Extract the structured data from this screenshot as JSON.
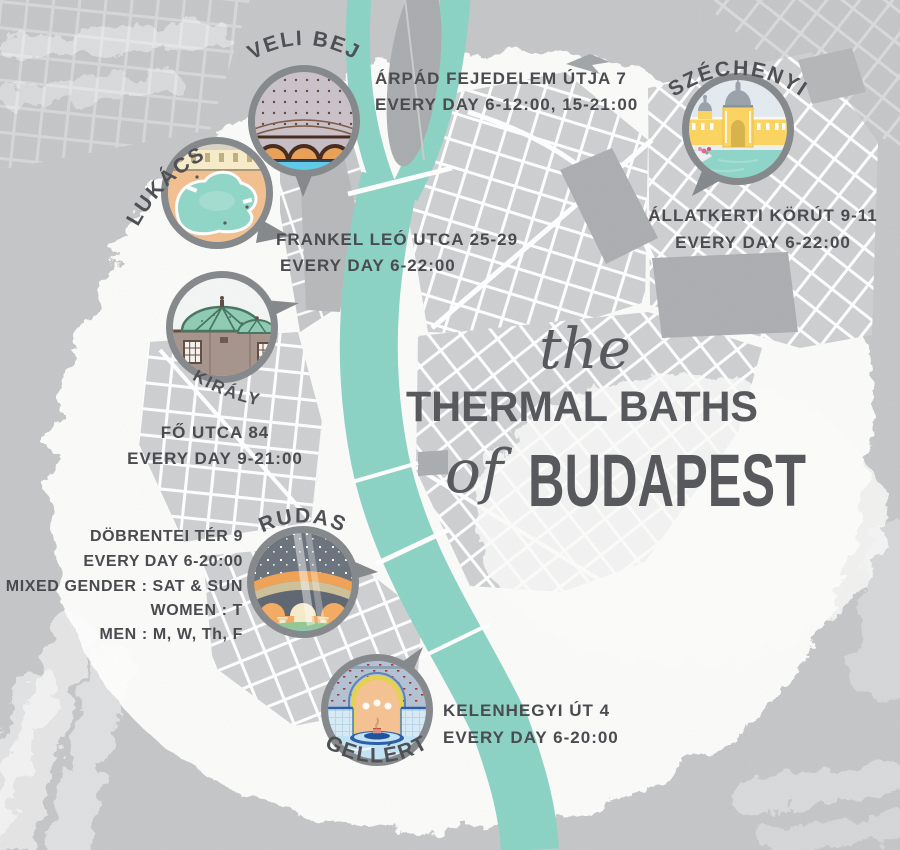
{
  "title": {
    "word_the": "the",
    "line_main": "THERMAL BATHS",
    "word_of": "of",
    "line_city": "BUDAPEST"
  },
  "baths": [
    {
      "id": "veli-bej",
      "name": "VELI BEJ",
      "address": "ÁRPÁD FEJEDELEM ÚTJA 7",
      "hours": "EVERY DAY 6-12:00, 15-21:00"
    },
    {
      "id": "lukacs",
      "name": "LUKÁCS",
      "address": "FRANKEL LEÓ UTCA 25-29",
      "hours": "EVERY DAY 6-22:00"
    },
    {
      "id": "szechenyi",
      "name": "SZÉCHENYI",
      "address": "ÁLLATKERTI KÖRÚT 9-11",
      "hours": "EVERY DAY 6-22:00"
    },
    {
      "id": "kiraly",
      "name": "KIRÁLY",
      "address": "FŐ UTCA 84",
      "hours": "EVERY DAY 9-21:00"
    },
    {
      "id": "rudas",
      "name": "RUDAS",
      "address": "DÖBRENTEI TÉR 9",
      "hours": "EVERY DAY 6-20:00",
      "extra1": "MIXED GENDER : SAT & SUN",
      "extra2": "WOMEN : T",
      "extra3": "MEN : M, W, Th, F"
    },
    {
      "id": "gellert",
      "name": "GELLÉRT",
      "address": "KELENHEGYI ÚT 4",
      "hours": "EVERY DAY 6-20:00"
    }
  ],
  "colors": {
    "background": "#C5C6C8",
    "paper": "#FBFBFA",
    "river": "#8BD3C4",
    "block": "#CDCFD1",
    "block_dark": "#ABAEB0",
    "ink": "#47484C",
    "ring": "#84888B",
    "title": "#55565A"
  }
}
